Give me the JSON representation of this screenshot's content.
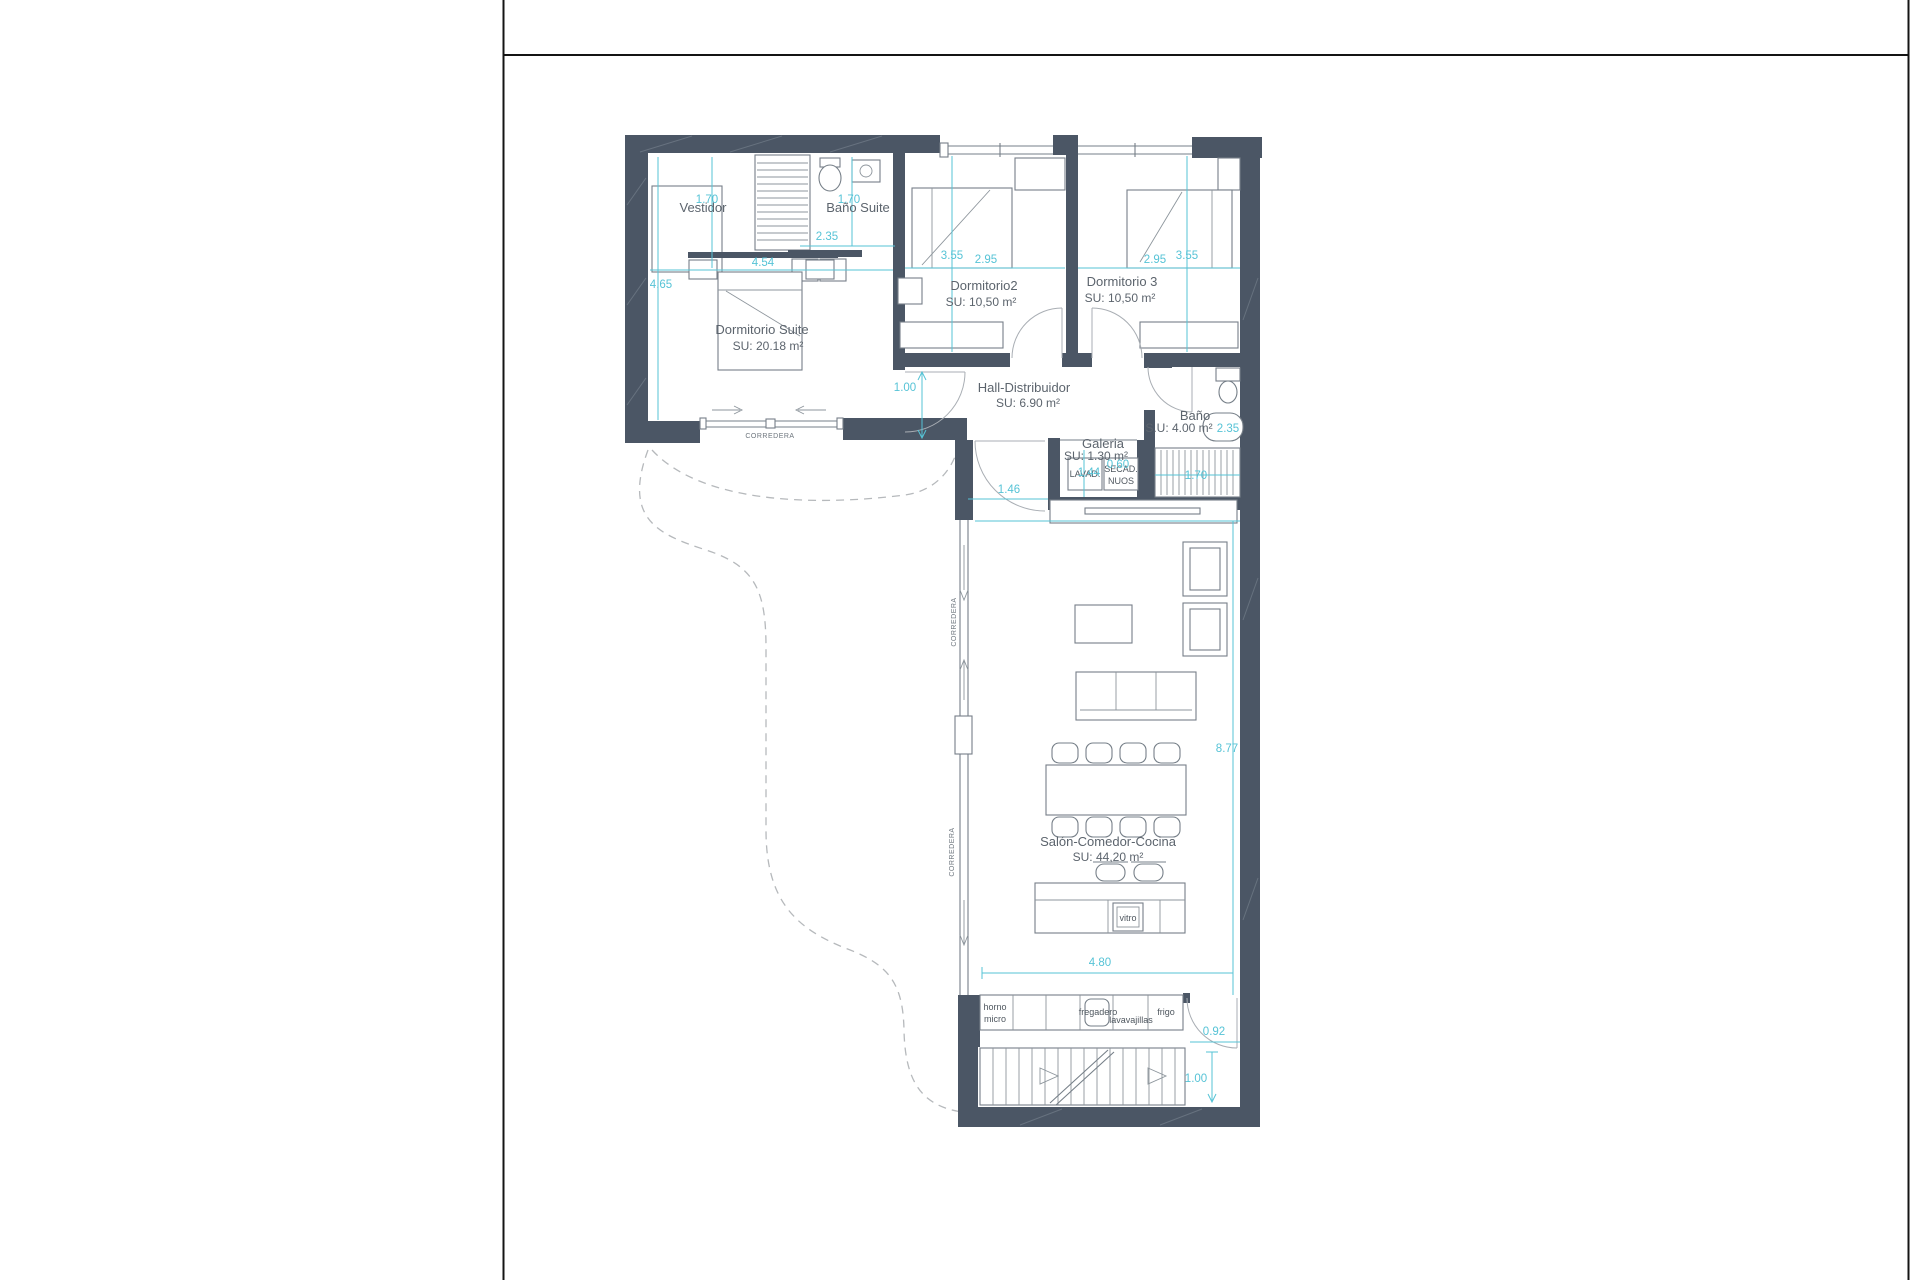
{
  "rooms": {
    "vestidor": {
      "name": "Vestidor"
    },
    "banoSuite": {
      "name": "Baño Suite"
    },
    "dormitorioSuite": {
      "name": "Dormitorio Suite",
      "area": "SU: 20.18 m²"
    },
    "dormitorio2": {
      "name": "Dormitorio2",
      "area": "SU: 10,50 m²"
    },
    "dormitorio3": {
      "name": "Dormitorio 3",
      "area": "SU: 10,50 m²"
    },
    "hall": {
      "name": "Hall-Distribuidor",
      "area": "SU: 6.90 m²"
    },
    "bano": {
      "name": "Baño",
      "area": "S.U: 4.00 m²"
    },
    "galeria": {
      "name": "Galeria",
      "area": "SU: 1.30 m²"
    },
    "salon": {
      "name": "Salón-Comedor-Cocina",
      "area": "SU: 44,20 m²"
    }
  },
  "appliances": {
    "lavadora": "LAVAD.",
    "secadora": "SECAD.",
    "nuos": "NUOS",
    "vitro": "vitro",
    "horno": "horno",
    "micro": "micro",
    "fregadero": "fregadero",
    "lavavajillas": "lavavajillas",
    "frigo": "frigo"
  },
  "dimensions": {
    "vestidor_width": "1.70",
    "suite_left_height": "4.65",
    "suite_width": "4.54",
    "bano_suite_width": "1.70",
    "bano_suite_depth": "2.35",
    "dorm2_depth": "3.55",
    "dorm2_width": "2.95",
    "dorm3_width": "2.95",
    "dorm3_depth": "3.55",
    "hall_opening": "1.00",
    "bath_tub_length": "2.35",
    "galeria_lavadora": "1.44",
    "galeria_secadora": "0.60",
    "stairs_width": "1.70",
    "hall_door": "1.46",
    "salon_length": "8.77",
    "salon_width": "4.80",
    "entry_door": "0.92",
    "stair_landing": "1.00"
  },
  "labels": {
    "corredera": "CORREDERA"
  },
  "colors": {
    "wall": "#4b5665",
    "dimension": "#56c3d6",
    "room_text": "#5c646d",
    "frame": "#141414"
  }
}
